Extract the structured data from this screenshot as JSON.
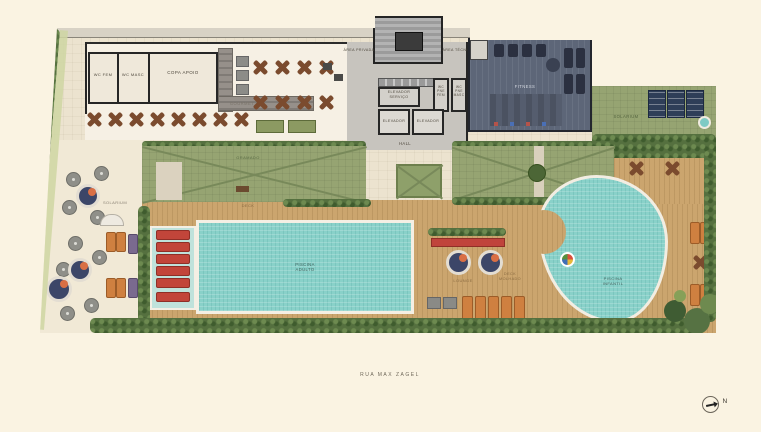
{
  "plan": {
    "street_label": "RUA MAX ZAGEL",
    "north_label": "N"
  },
  "building_core": {
    "area_privada": "ÁREA PRIVADA",
    "area_tecnica": "ÁREA TÉCNICA",
    "elevador_servico": "ELEVADOR SERVIÇO",
    "elevador_1": "ELEVADOR",
    "elevador_2": "ELEVADOR",
    "hall": "HALL",
    "wc_pne_fem": "WC PNE FEM",
    "wc_pne_masc": "WC PNE MASC"
  },
  "gourmet_area": {
    "wc_fem": "WC FEM",
    "wc_masc": "WC MASC",
    "copa_apoio": "COPA APOIO",
    "gourmet": "GOURMET"
  },
  "amenities": {
    "fitness": "FITNESS",
    "solarium_roof": "SOLARIUM",
    "gramado": "GRAMADO",
    "deck": "DECK",
    "lounge": "LOUNGE",
    "deck_molhado": "DECK MOLHADO",
    "solarium_beach": "SOLARIUM",
    "piscina_adulto": "PISCINA ADULTO",
    "piscina_infantil": "PISCINA INFANTIL"
  },
  "colors": {
    "background": "#faf3e2",
    "paving": "#ece3cf",
    "deck_wood": "#cba56e",
    "lawn_green": "#96a472",
    "pool_water": "#89d1c9",
    "hedge_green": "#55703f",
    "fitness_floor": "#5d6678",
    "lounger_red": "#c2453a",
    "lounger_orange": "#cf8040",
    "sand": "#f1e9d6"
  }
}
